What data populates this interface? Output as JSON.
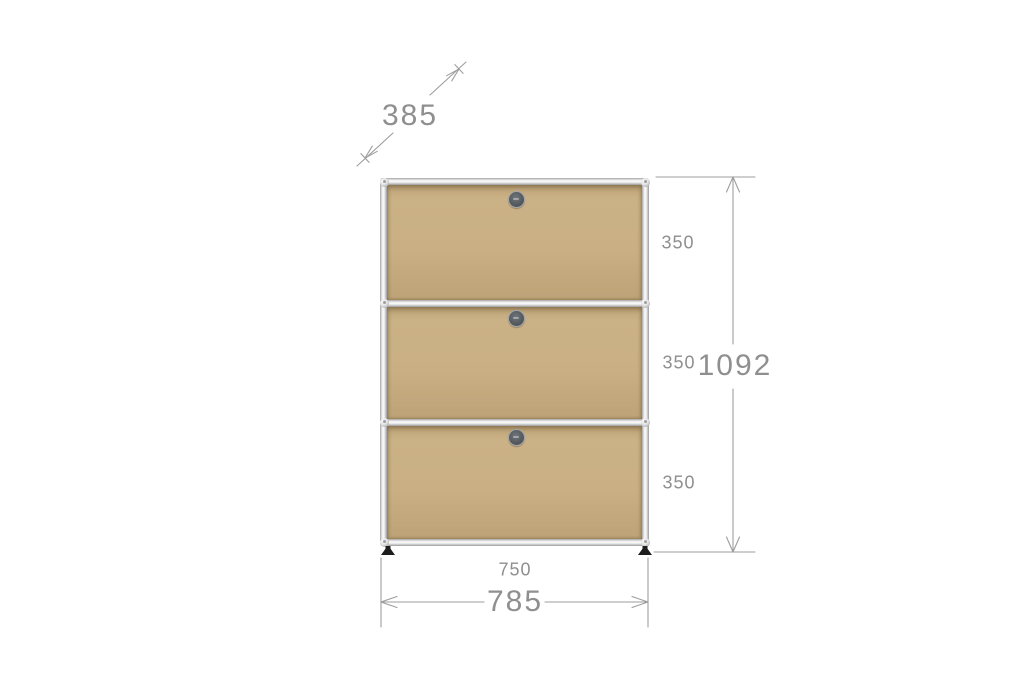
{
  "colors": {
    "background": "#ffffff",
    "panel": "#c7ab7d",
    "dim-line": "#9e9e9e",
    "dim-text": "#8f8f8f",
    "foot": "#1d1d1d"
  },
  "cabinet": {
    "type": "modular sideboard",
    "door_count": 3
  },
  "dimensions": {
    "depth": "385",
    "sections": [
      "350",
      "350",
      "350"
    ],
    "total_height": "1092",
    "inner_width": "750",
    "outer_width": "785"
  }
}
